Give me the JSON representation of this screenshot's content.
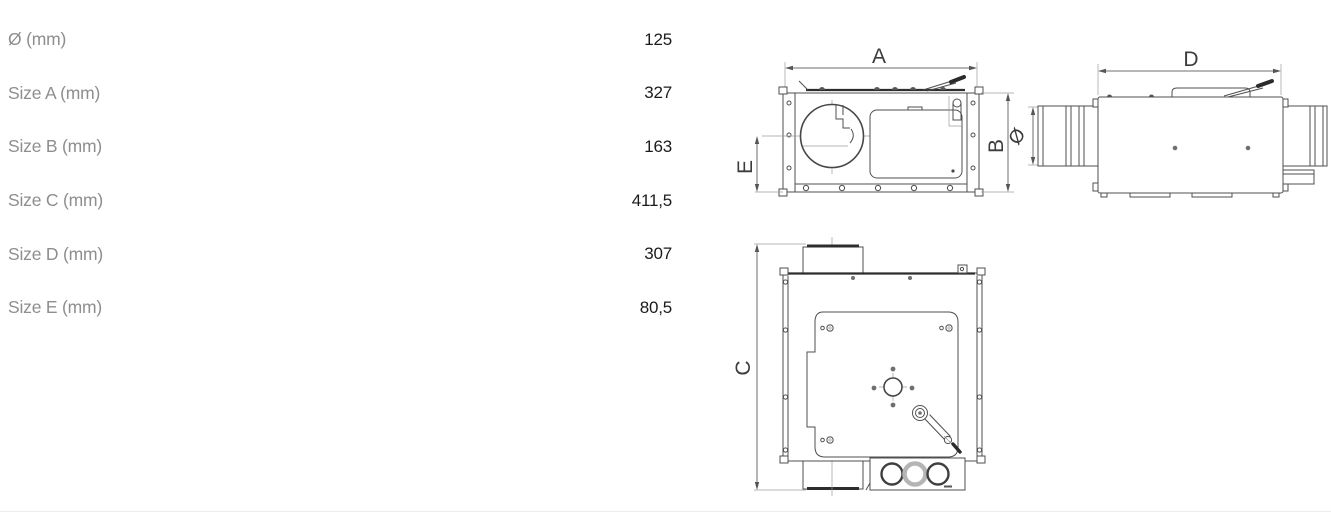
{
  "dimension_table": {
    "rows": [
      {
        "label": "Ø (mm)",
        "value": "125"
      },
      {
        "label": "Size A (mm)",
        "value": "327"
      },
      {
        "label": "Size B (mm)",
        "value": "163"
      },
      {
        "label": "Size C (mm)",
        "value": "411,5"
      },
      {
        "label": "Size D (mm)",
        "value": "307"
      },
      {
        "label": "Size E (mm)",
        "value": "80,5"
      }
    ]
  },
  "diagram": {
    "front_view": {
      "width_label": "A",
      "height_label": "B",
      "outlet_offset_label": "E"
    },
    "side_view": {
      "length_label": "D",
      "diameter_label": "Ø"
    },
    "top_view": {
      "depth_label": "C"
    }
  },
  "colors": {
    "drawing_line": "#4f4f4f",
    "table_label_text": "#8e8e8e",
    "table_value_text": "#1b1b1b",
    "dimension_text": "#3c3c3c"
  }
}
